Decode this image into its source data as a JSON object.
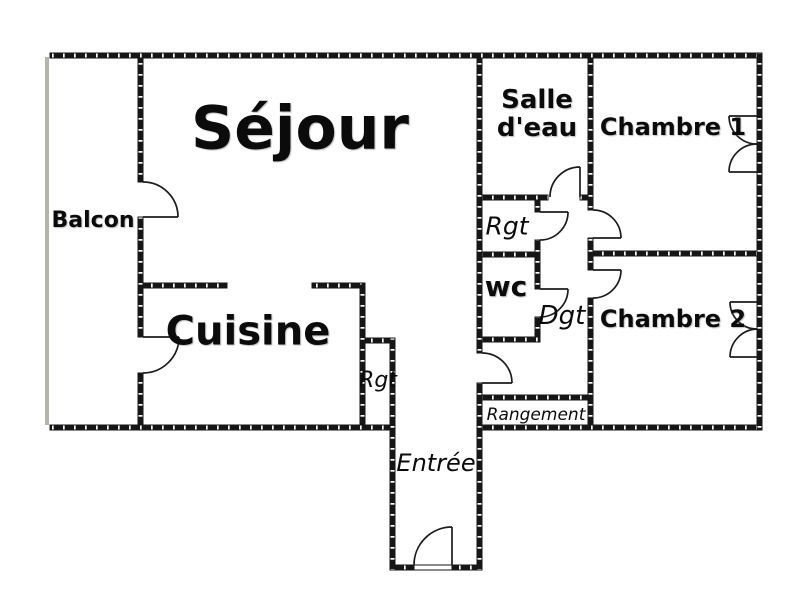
{
  "plan_title": "Apartment floor plan",
  "rooms": {
    "sejour": {
      "label": "Séjour"
    },
    "balcon": {
      "label": "Balcon"
    },
    "cuisine": {
      "label": "Cuisine"
    },
    "salle_deau": {
      "label_line1": "Salle",
      "label_line2": "d'eau"
    },
    "chambre1": {
      "label": "Chambre 1"
    },
    "chambre2": {
      "label": "Chambre 2"
    },
    "rgt_hall": {
      "label": "Rgt"
    },
    "wc": {
      "label": "wc"
    },
    "dgt": {
      "label": "Dgt"
    },
    "rgt_cuisine": {
      "label": "Rgt"
    },
    "rangement": {
      "label": "Rangement"
    },
    "entree": {
      "label": "Entrée"
    }
  },
  "colors": {
    "wall": "#161616",
    "door_line": "#1c1c1c",
    "balcony_edge": "#b5b5ae",
    "text": "#0b0b0b",
    "background": "#ffffff"
  }
}
